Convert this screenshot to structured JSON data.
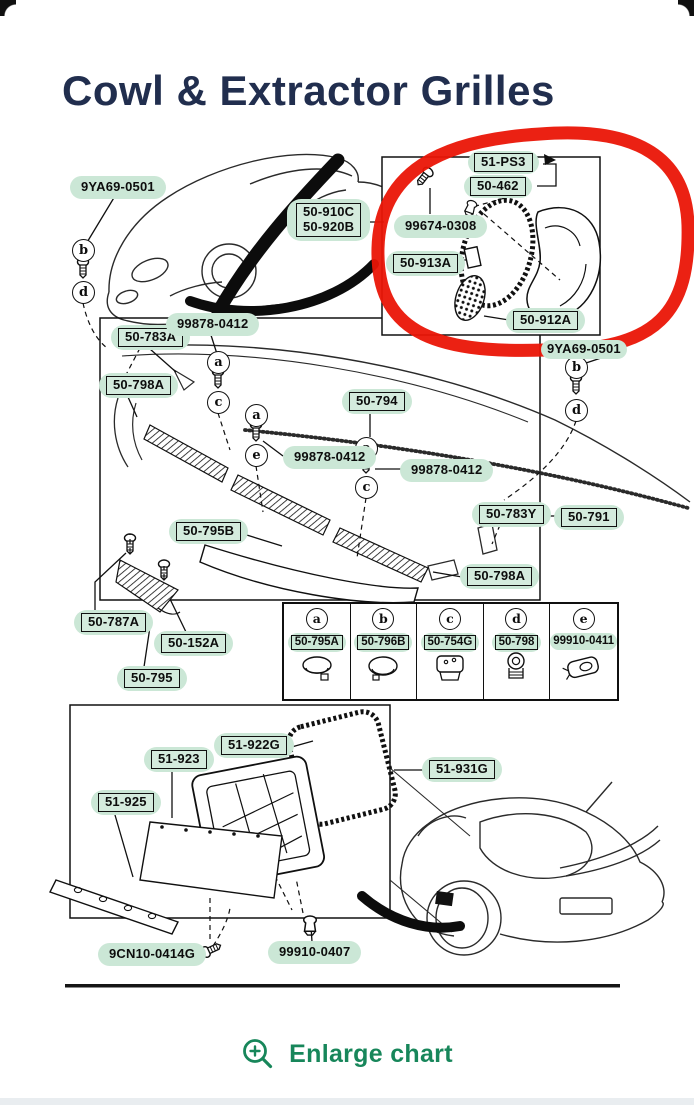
{
  "header": {
    "title": "Cowl & Extractor Grilles"
  },
  "colors": {
    "highlight_green": "#cbe7d6",
    "marker_red": "#ea1506",
    "link_green": "#17865a",
    "title_navy": "#212e4e",
    "line_black": "#101010"
  },
  "diagram": {
    "labels": [
      {
        "text": "9YA69-0501",
        "boxed": false
      },
      {
        "text": "50-910C",
        "boxed": true
      },
      {
        "text": "50-920B",
        "boxed": true
      },
      {
        "text": "51-PS3",
        "boxed": true
      },
      {
        "text": "50-462",
        "boxed": true
      },
      {
        "text": "99674-0308",
        "boxed": false
      },
      {
        "text": "50-913A",
        "boxed": true
      },
      {
        "text": "50-912A",
        "boxed": true
      },
      {
        "text": "9YA69-0501",
        "boxed": false
      },
      {
        "text": "50-783A",
        "boxed": true
      },
      {
        "text": "99878-0412",
        "boxed": false
      },
      {
        "text": "50-798A",
        "boxed": true
      },
      {
        "text": "50-794",
        "boxed": true
      },
      {
        "text": "99878-0412",
        "boxed": false
      },
      {
        "text": "99878-0412",
        "boxed": false
      },
      {
        "text": "50-783Y",
        "boxed": true
      },
      {
        "text": "50-791",
        "boxed": true
      },
      {
        "text": "50-795B",
        "boxed": true
      },
      {
        "text": "50-798A",
        "boxed": true
      },
      {
        "text": "50-787A",
        "boxed": true
      },
      {
        "text": "50-152A",
        "boxed": true
      },
      {
        "text": "50-795",
        "boxed": true
      },
      {
        "text": "51-923",
        "boxed": true
      },
      {
        "text": "51-922G",
        "boxed": true
      },
      {
        "text": "51-931G",
        "boxed": true
      },
      {
        "text": "51-925",
        "boxed": true
      },
      {
        "text": "9CN10-0414G",
        "boxed": false
      },
      {
        "text": "99910-0407",
        "boxed": false
      }
    ],
    "callout_letters": [
      "b",
      "d",
      "a",
      "c",
      "a",
      "e",
      "a",
      "c",
      "b",
      "d"
    ],
    "legend": [
      {
        "letter": "a",
        "part": "50-795A",
        "boxed": true
      },
      {
        "letter": "b",
        "part": "50-796B",
        "boxed": true
      },
      {
        "letter": "c",
        "part": "50-754G",
        "boxed": true
      },
      {
        "letter": "d",
        "part": "50-798",
        "boxed": true
      },
      {
        "letter": "e",
        "part": "99910-0411",
        "boxed": false
      }
    ]
  },
  "footer": {
    "enlarge_label": "Enlarge chart",
    "icon": "zoom-in-icon"
  }
}
